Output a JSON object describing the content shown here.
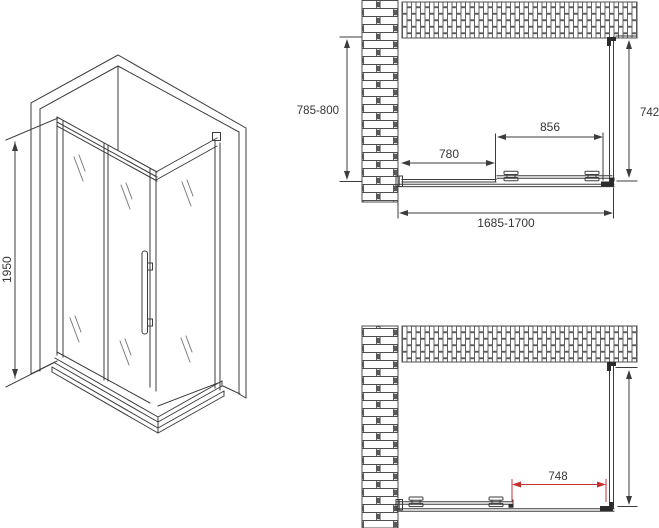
{
  "colors": {
    "line": "#3c3c3c",
    "red": "#c53030",
    "background": "#ffffff"
  },
  "iso_view": {
    "height_label": "1950"
  },
  "plan_top": {
    "depth_label": "785-800",
    "inner_depth_label": "742",
    "fixed_panel_label": "780",
    "door_label": "856",
    "total_width_label": "1685-1700"
  },
  "plan_bottom": {
    "opening_label": "748"
  }
}
